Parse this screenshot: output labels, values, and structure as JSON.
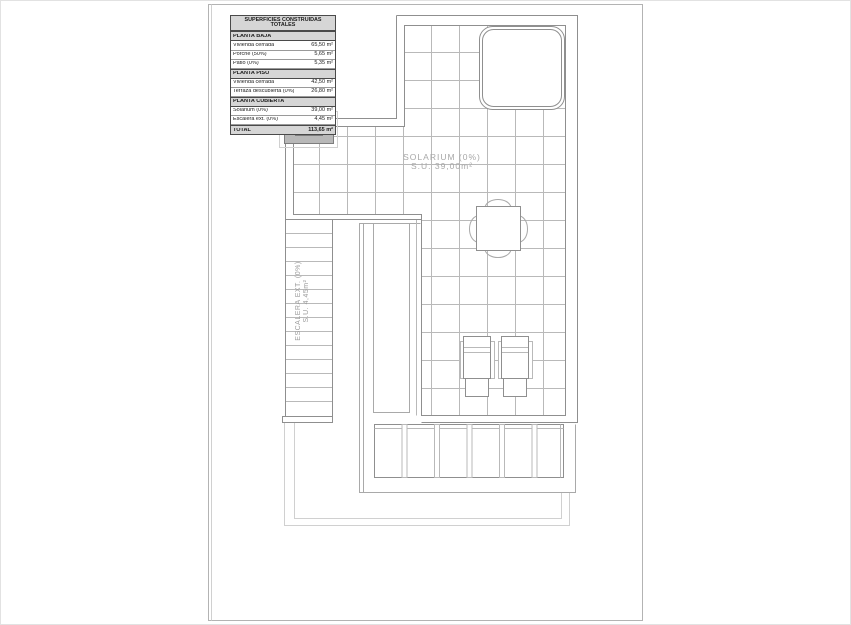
{
  "surface_table": {
    "title": "SUPERFICIES CONSTRUIDAS TOTALES",
    "rows": [
      {
        "label": "PLANTA BAJA",
        "value": ""
      },
      {
        "label": "Vivienda cerrada",
        "value": "65,50 m²"
      },
      {
        "label": "Porche (50%)",
        "value": "5,65 m²"
      },
      {
        "label": "Patio (0%)",
        "value": "5,35 m²"
      },
      {
        "label": "PLANTA PISO",
        "value": ""
      },
      {
        "label": "Vivienda cerrada",
        "value": "42,50 m²"
      },
      {
        "label": "Terraza descubierta (0%)",
        "value": "26,80 m²"
      },
      {
        "label": "PLANTA CUBIERTA",
        "value": ""
      },
      {
        "label": "Solarium (0%)",
        "value": "39,00 m²"
      },
      {
        "label": "Escalera ext. (0%)",
        "value": "4,45 m²"
      },
      {
        "label": "TOTAL",
        "value": "113,65 m²"
      }
    ]
  },
  "plan": {
    "solarium_label": "SOLARIUM (0%)",
    "solarium_area": "S.U. 39,00m²",
    "stairs_label": "ESCALERA EXT. (0%)",
    "stairs_area": "S.U. 4,45m²"
  },
  "colors": {
    "wall_line": "#8f8f8f",
    "tile_line": "#b9b9b9",
    "chimney_fill": "#b8b8b8",
    "table_header_bg": "#d6d6d6"
  }
}
